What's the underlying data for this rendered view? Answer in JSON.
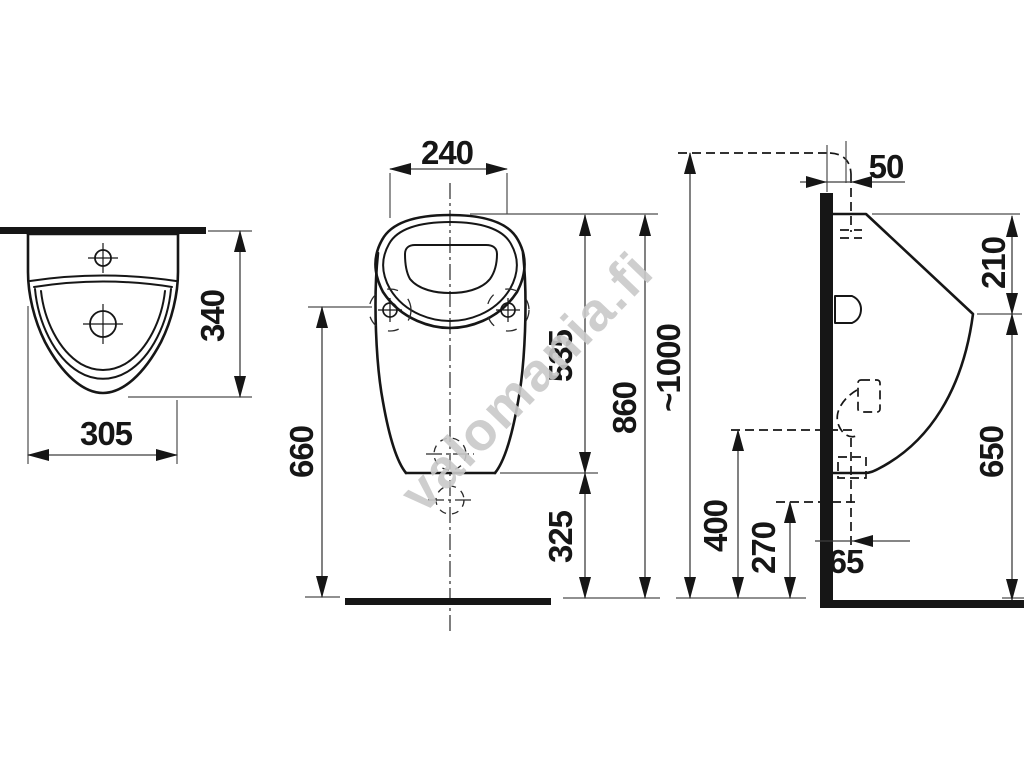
{
  "drawing": {
    "subject": "urinal installation dimension drawing",
    "units": "mm"
  },
  "watermark": {
    "text": "valomania.fi",
    "color": "#c9c9c9"
  },
  "colors": {
    "outline": "#161616",
    "thin_line": "#4d4d4d",
    "background": "#ffffff",
    "watermark": "#c9c9c9"
  },
  "dimensions": {
    "top_width": "305",
    "top_depth": "340",
    "rim_width": "240",
    "rim_to_outlet": "535",
    "outlet_to_floor": "325",
    "rim_to_floor": "860",
    "fixing_holes_to_floor": "660",
    "inlet_wall_offset": "50",
    "installation_height": "~1000",
    "rim_to_spout_front": "210",
    "spout_front_to_floor": "650",
    "inlet_connection_height": "400",
    "outlet_connection_height": "270",
    "outlet_wall_offset": "65"
  }
}
